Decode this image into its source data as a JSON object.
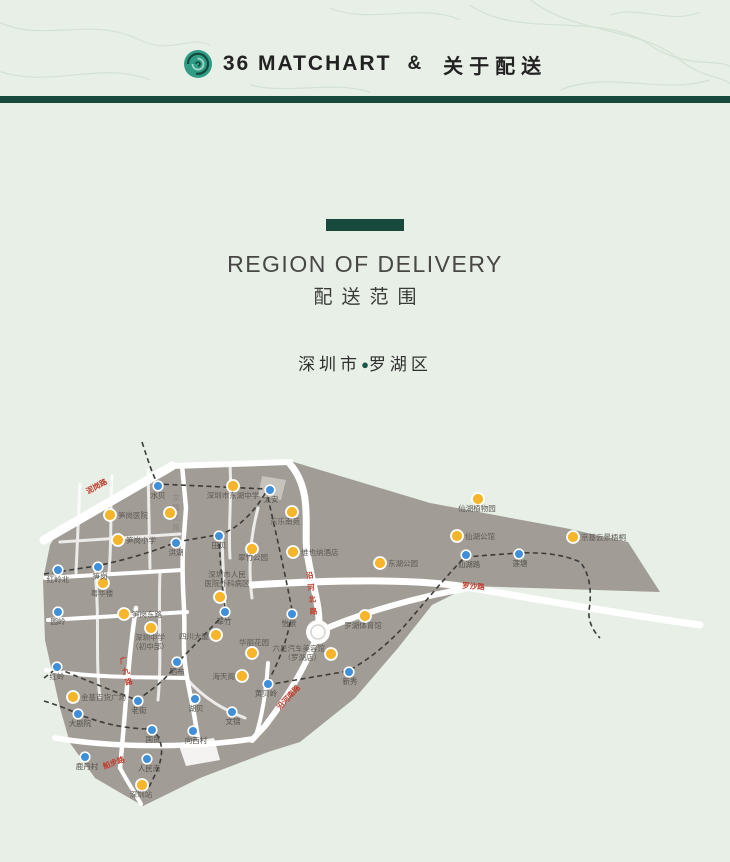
{
  "header": {
    "logo": "rose-logo-icon",
    "brand": "36 MATCHART",
    "amp": "&",
    "title": "关于配送"
  },
  "section": {
    "title_en": "REGION OF DELIVERY",
    "title_zh": "配送范围",
    "location_city": "深圳市",
    "location_sep": "●",
    "location_district": "罗湖区"
  },
  "map": {
    "colors": {
      "district": "#a19c96",
      "road": "#ffffff",
      "railway": "#3c3c3a",
      "poi": "#f7b52c",
      "station": "#3f8fdb",
      "road_label_red": "#c23b2a",
      "accent_green": "#17493c"
    },
    "stations": [
      {
        "label": "水贝",
        "x": 158,
        "y": 48,
        "lx": 158,
        "ly": 60,
        "anchor": "middle"
      },
      {
        "label": "太安",
        "x": 270,
        "y": 52,
        "lx": 271,
        "ly": 64,
        "anchor": "middle"
      },
      {
        "label": "田贝",
        "x": 219,
        "y": 98,
        "lx": 219,
        "ly": 110,
        "anchor": "middle"
      },
      {
        "label": "洪湖",
        "x": 176,
        "y": 105,
        "lx": 176,
        "ly": 117,
        "anchor": "middle"
      },
      {
        "label": "笋岗",
        "x": 98,
        "y": 129,
        "lx": 100,
        "ly": 141,
        "anchor": "middle"
      },
      {
        "label": "红岭北",
        "x": 58,
        "y": 132,
        "lx": 58,
        "ly": 144,
        "anchor": "middle"
      },
      {
        "label": "园岭",
        "x": 58,
        "y": 174,
        "lx": 58,
        "ly": 186,
        "anchor": "middle"
      },
      {
        "label": "红岭",
        "x": 57,
        "y": 229,
        "lx": 57,
        "ly": 241,
        "anchor": "middle"
      },
      {
        "label": "翠竹",
        "x": 225,
        "y": 174,
        "lx": 224,
        "ly": 186,
        "anchor": "middle"
      },
      {
        "label": "晒布",
        "x": 177,
        "y": 224,
        "lx": 177,
        "ly": 236,
        "anchor": "middle"
      },
      {
        "label": "怡景",
        "x": 292,
        "y": 176,
        "lx": 289,
        "ly": 188,
        "anchor": "middle"
      },
      {
        "label": "仙湖路",
        "x": 466,
        "y": 117,
        "lx": 469,
        "ly": 129,
        "anchor": "middle"
      },
      {
        "label": "莲塘",
        "x": 519,
        "y": 116,
        "lx": 520,
        "ly": 128,
        "anchor": "middle"
      },
      {
        "label": "新秀",
        "x": 349,
        "y": 234,
        "lx": 350,
        "ly": 246,
        "anchor": "middle"
      },
      {
        "label": "黄贝岭",
        "x": 268,
        "y": 246,
        "lx": 266,
        "ly": 258,
        "anchor": "middle"
      },
      {
        "label": "老街",
        "x": 138,
        "y": 263,
        "lx": 139,
        "ly": 275,
        "anchor": "middle"
      },
      {
        "label": "湖贝",
        "x": 195,
        "y": 261,
        "lx": 196,
        "ly": 273,
        "anchor": "middle"
      },
      {
        "label": "文锦",
        "x": 232,
        "y": 274,
        "lx": 233,
        "ly": 286,
        "anchor": "middle"
      },
      {
        "label": "大剧院",
        "x": 78,
        "y": 276,
        "lx": 80,
        "ly": 288,
        "anchor": "middle"
      },
      {
        "label": "国贸",
        "x": 152,
        "y": 292,
        "lx": 153,
        "ly": 304,
        "anchor": "middle"
      },
      {
        "label": "向西村",
        "x": 193,
        "y": 293,
        "lx": 196,
        "ly": 305,
        "anchor": "middle"
      },
      {
        "label": "鹿丹村",
        "x": 85,
        "y": 319,
        "lx": 87,
        "ly": 331,
        "anchor": "middle"
      },
      {
        "label": "人民南",
        "x": 147,
        "y": 321,
        "lx": 149,
        "ly": 333,
        "anchor": "middle"
      }
    ],
    "pois": [
      {
        "x": 110,
        "y": 77,
        "anchor": "start",
        "lines": [
          {
            "t": "笋岗医院",
            "x": 118,
            "y": 80
          }
        ]
      },
      {
        "x": 118,
        "y": 102,
        "anchor": "start",
        "lines": [
          {
            "t": "笋岗小学",
            "x": 126,
            "y": 105
          }
        ]
      },
      {
        "x": 170,
        "y": 75,
        "anchor": "start",
        "lines": []
      },
      {
        "x": 233,
        "y": 48,
        "anchor": "middle",
        "lines": [
          {
            "t": "深圳市东湖中学",
            "x": 233,
            "y": 60
          }
        ]
      },
      {
        "x": 292,
        "y": 74,
        "anchor": "middle",
        "lines": [
          {
            "t": "东乐南苑",
            "x": 285,
            "y": 86
          }
        ]
      },
      {
        "x": 252,
        "y": 111,
        "anchor": "middle",
        "lines": [
          {
            "t": "翠竹公园",
            "x": 253,
            "y": 122
          }
        ]
      },
      {
        "x": 220,
        "y": 159,
        "anchor": "middle",
        "lines": [
          {
            "t": "深圳市人民",
            "x": 227,
            "y": 139
          },
          {
            "t": "医院外科病区",
            "x": 227,
            "y": 148
          }
        ]
      },
      {
        "x": 103,
        "y": 145,
        "anchor": "middle",
        "lines": [
          {
            "t": "粤华楼",
            "x": 102,
            "y": 158
          }
        ]
      },
      {
        "x": 124,
        "y": 176,
        "anchor": "start",
        "lines": [
          {
            "t": "笋岗东路",
            "x": 132,
            "y": 179
          }
        ]
      },
      {
        "x": 151,
        "y": 190,
        "anchor": "middle",
        "lines": [
          {
            "t": "深圳中学",
            "x": 150,
            "y": 202
          },
          {
            "t": "（初中部）",
            "x": 150,
            "y": 211
          }
        ]
      },
      {
        "x": 216,
        "y": 197,
        "anchor": "end",
        "lines": [
          {
            "t": "四川大厦",
            "x": 209,
            "y": 201
          }
        ]
      },
      {
        "x": 252,
        "y": 215,
        "anchor": "middle",
        "lines": [
          {
            "t": "华丽花园",
            "x": 254,
            "y": 207
          }
        ]
      },
      {
        "x": 242,
        "y": 238,
        "anchor": "end",
        "lines": [
          {
            "t": "海天阁",
            "x": 235,
            "y": 241
          }
        ]
      },
      {
        "x": 293,
        "y": 114,
        "anchor": "start",
        "lines": [
          {
            "t": "维也纳酒店",
            "x": 301,
            "y": 117
          }
        ]
      },
      {
        "x": 380,
        "y": 125,
        "anchor": "start",
        "lines": [
          {
            "t": "东湖公园",
            "x": 388,
            "y": 128
          }
        ]
      },
      {
        "x": 478,
        "y": 61,
        "anchor": "middle",
        "lines": [
          {
            "t": "仙湖植物园",
            "x": 477,
            "y": 73
          }
        ]
      },
      {
        "x": 457,
        "y": 98,
        "anchor": "start",
        "lines": [
          {
            "t": "仙湖公馆",
            "x": 465,
            "y": 101
          }
        ]
      },
      {
        "x": 573,
        "y": 99,
        "anchor": "start",
        "lines": [
          {
            "t": "京基云景梧桐",
            "x": 581,
            "y": 102
          }
        ]
      },
      {
        "x": 365,
        "y": 178,
        "anchor": "middle",
        "lines": [
          {
            "t": "罗湖体育馆",
            "x": 363,
            "y": 190
          }
        ]
      },
      {
        "x": 331,
        "y": 216,
        "anchor": "end",
        "lines": [
          {
            "t": "六星汽车美容馆",
            "x": 325,
            "y": 213
          },
          {
            "t": "（罗湖店）",
            "x": 321,
            "y": 222
          }
        ]
      },
      {
        "x": 73,
        "y": 259,
        "anchor": "start",
        "lines": [
          {
            "t": "金基百货广场",
            "x": 81,
            "y": 262
          }
        ]
      },
      {
        "x": 142,
        "y": 347,
        "anchor": "middle",
        "lines": [
          {
            "t": "深圳站",
            "x": 141,
            "y": 359
          }
        ]
      }
    ],
    "road_labels": [
      {
        "text": "泥岗路",
        "x": 88,
        "y": 56,
        "rotate": -29,
        "cls": "rlabel-red"
      },
      {
        "text": "文锦北路",
        "x": 176,
        "y": 62,
        "cls": "rlabel-gray",
        "vertical": true,
        "step": 10
      },
      {
        "text": "沿河北路",
        "x": 310,
        "y": 140,
        "rotate": -6,
        "cls": "rlabel-red",
        "vertical": true,
        "step": 12
      },
      {
        "text": "罗沙路",
        "x": 462,
        "y": 150,
        "rotate": 4,
        "cls": "rlabel-red"
      },
      {
        "text": "广九路",
        "x": 124,
        "y": 225,
        "rotate": -14,
        "cls": "rlabel-red",
        "vertical": true,
        "step": 11
      },
      {
        "text": "沿河南路",
        "x": 280,
        "y": 272,
        "rotate": -47,
        "cls": "rlabel-red"
      },
      {
        "text": "船步路",
        "x": 104,
        "y": 331,
        "rotate": -20,
        "cls": "rlabel-red"
      }
    ]
  }
}
